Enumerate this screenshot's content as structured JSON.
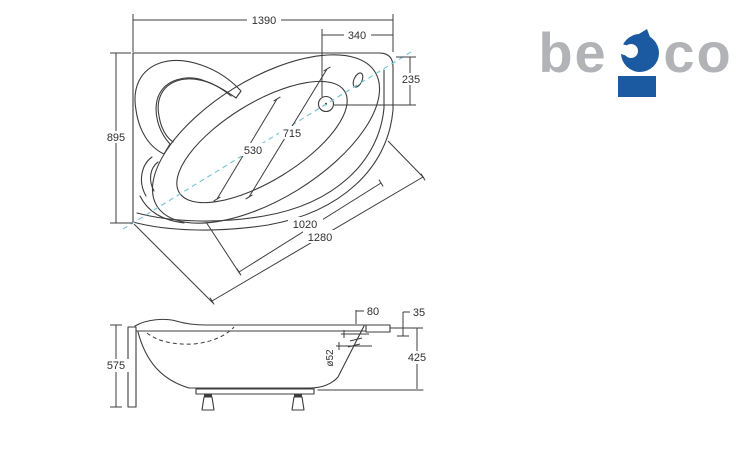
{
  "brand": {
    "name": "besco",
    "logo_text_left": "be",
    "logo_text_right": "co",
    "colors": {
      "gray": "#b1b3b6",
      "blue": "#1b5aa1"
    }
  },
  "colors": {
    "line": "#3c3c3c",
    "text": "#2f2f2f",
    "axis_dashed": "#7cc5d8",
    "background": "#ffffff"
  },
  "top_view": {
    "dim_overall_width": "1390",
    "dim_tap_offset": "340",
    "dim_tap_inset": "235",
    "dim_overall_depth": "895",
    "dim_inner_width_rear": "530",
    "dim_inner_width_front": "715",
    "dim_front_edge_inner": "1020",
    "dim_front_edge_outer": "1280"
  },
  "side_view": {
    "dim_total_height": "575",
    "dim_deck_width": "80",
    "dim_rim_drop": "35",
    "dim_shell_height": "425",
    "dim_drain_diameter": "ø52"
  }
}
